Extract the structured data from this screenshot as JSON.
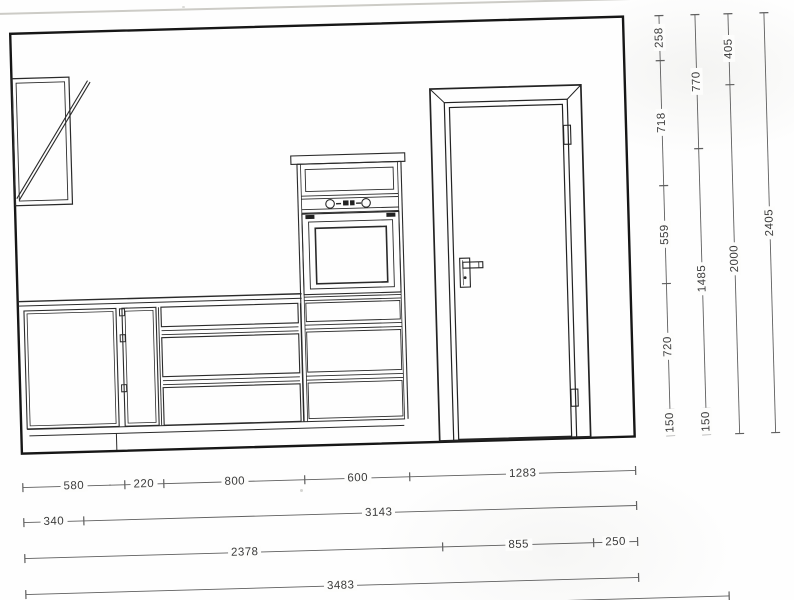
{
  "drawing_type": "kitchen-elevation-scan",
  "colors": {
    "paper": "#fefefe",
    "line": "#232323",
    "dim_line": "#5f5f5f",
    "label_text": "#3b3b3b",
    "page_edge": "#cccbc6"
  },
  "dims": {
    "right": [
      {
        "name": "wall-segment-heights",
        "segments": [
          "258",
          "718",
          "559",
          "720",
          "150"
        ]
      },
      {
        "name": "tall-unit-heights",
        "segments": [
          "770",
          "1485",
          "150"
        ]
      },
      {
        "name": "door-heights",
        "segments": [
          "405",
          "2000"
        ]
      },
      {
        "name": "overall-height",
        "segments": [
          "2405"
        ]
      }
    ],
    "bottom": [
      {
        "name": "unit-widths",
        "segments": [
          "580",
          "220",
          "800",
          "600",
          "1283"
        ]
      },
      {
        "name": "wall-cabinet-offset",
        "segments": [
          "340",
          "3143"
        ]
      },
      {
        "name": "door-offset-widths",
        "segments": [
          "2378",
          "855",
          "250"
        ]
      },
      {
        "name": "overall-width",
        "segments": [
          "3483"
        ]
      }
    ]
  }
}
